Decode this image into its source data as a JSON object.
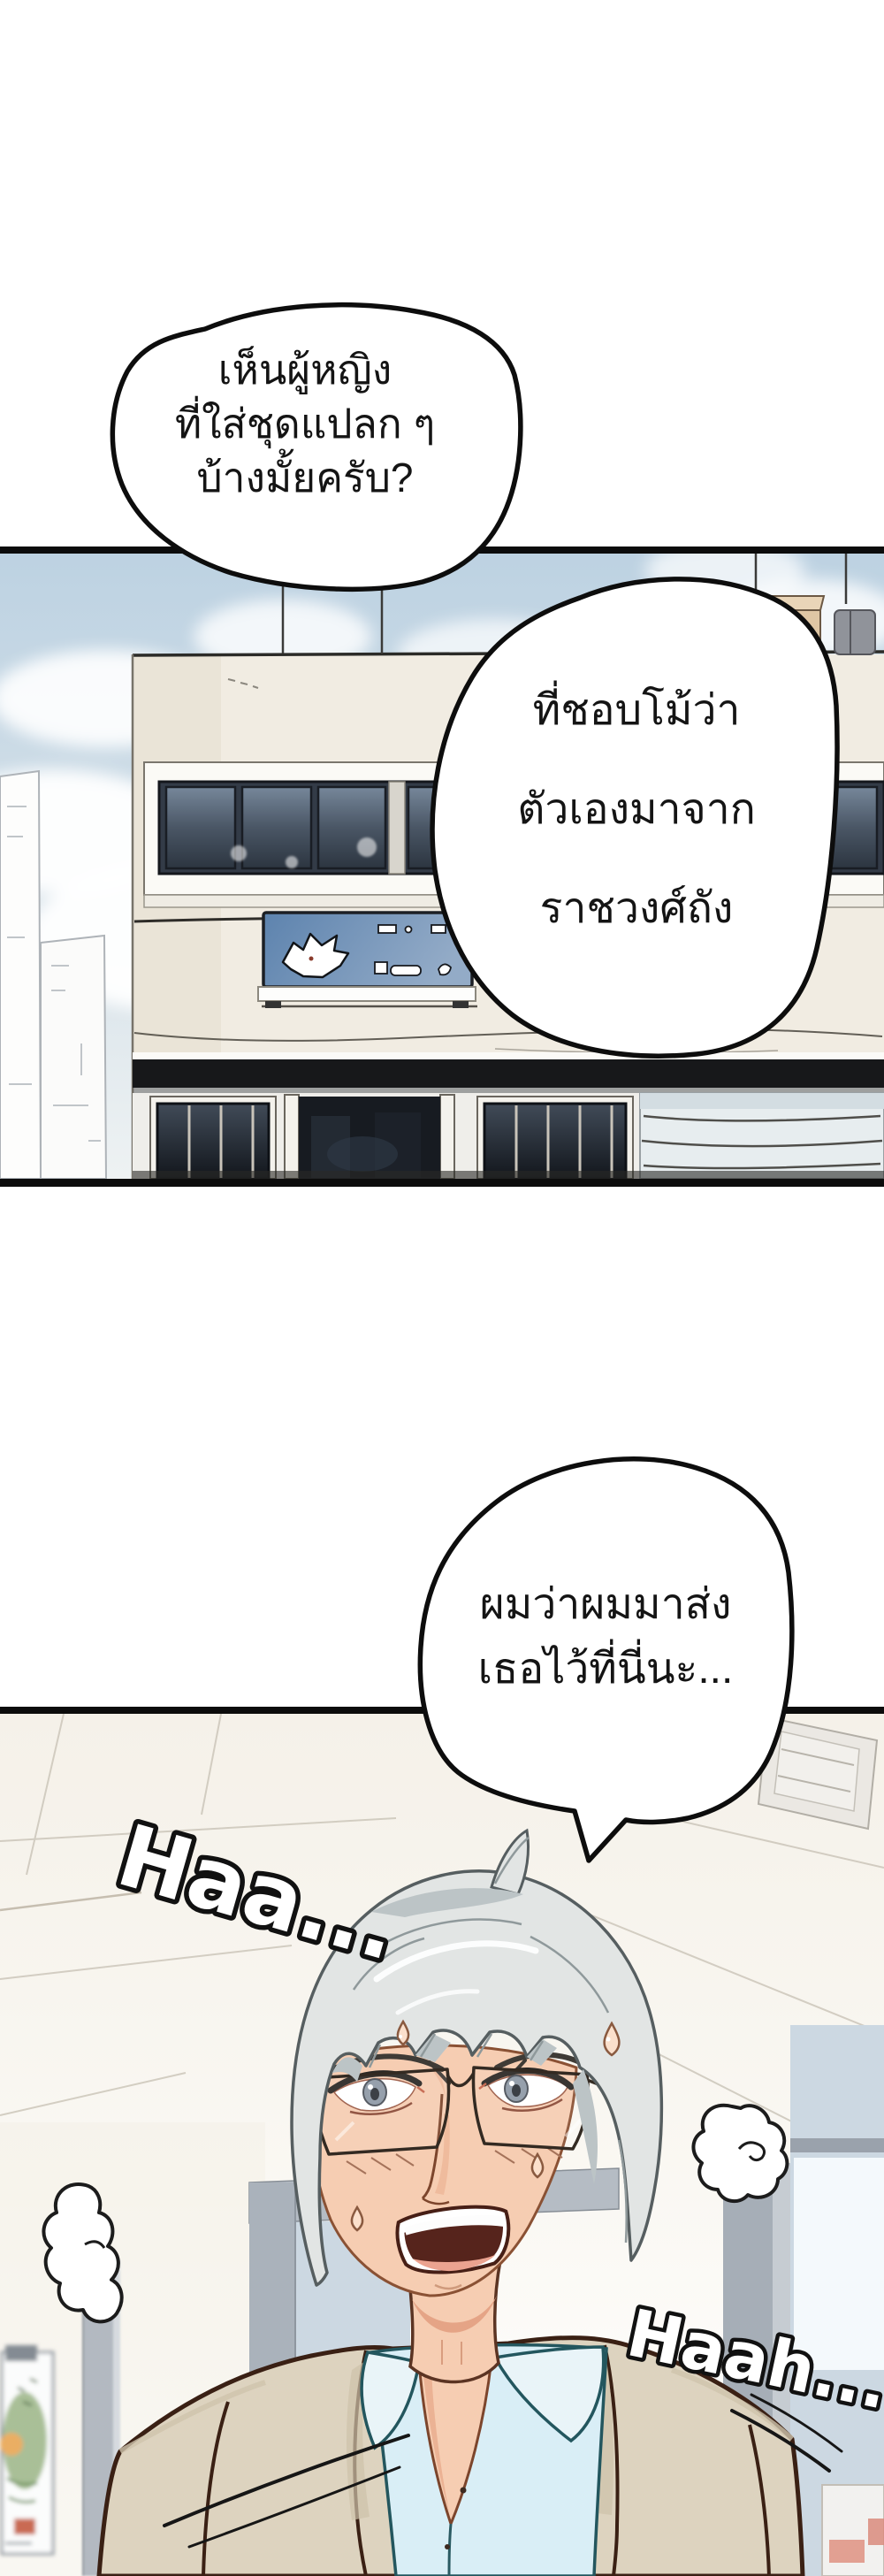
{
  "comic": {
    "speech_bubbles": [
      {
        "lines": [
          "เห็นผู้หญิง",
          "ที่ใส่ชุดแปลก ๆ",
          "บ้างมั้ยครับ?"
        ]
      },
      {
        "lines": [
          "ที่ชอบโม้ว่า",
          "ตัวเองมาจาก",
          "ราชวงศ์ถัง"
        ]
      },
      {
        "lines": [
          "ผมว่าผมมาส่ง",
          "เธอไว้ที่นี่นะ..."
        ]
      }
    ],
    "sfx": [
      {
        "text": "Haa..."
      },
      {
        "text": "Haah..."
      }
    ],
    "storefront_sign": {
      "icon": "dragon-logo",
      "color": "#5d83ae"
    },
    "colors": {
      "outline_black": "#111111",
      "sky_blue": "#c3d6e3",
      "building_wall": "#f1ece2",
      "awning_black": "#17181a",
      "window_glass": "#39434f",
      "hair_silver": "#e2e5e4",
      "skin": "#f6cdb2",
      "jacket_beige": "#ddd3bf",
      "shirt_cyan": "#d9eef6",
      "ceiling": "#f7f4ee"
    }
  }
}
